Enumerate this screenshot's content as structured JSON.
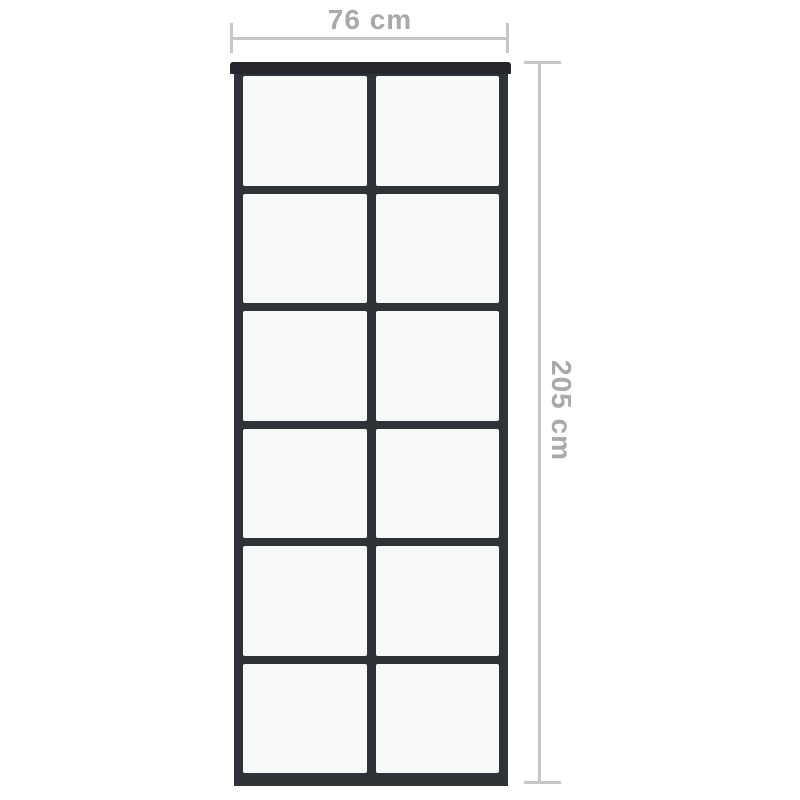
{
  "diagram": {
    "width_dimension": {
      "label": "76 cm"
    },
    "height_dimension": {
      "label": "205 cm"
    },
    "door": {
      "columns": 2,
      "rows": 6
    },
    "colors": {
      "background": "#ffffff",
      "frame": "#2f3338",
      "track": "#24262b",
      "glass": "#f8f9f9",
      "dim-line": "#c7c7c7",
      "dim-text": "#a9a9a9"
    }
  }
}
